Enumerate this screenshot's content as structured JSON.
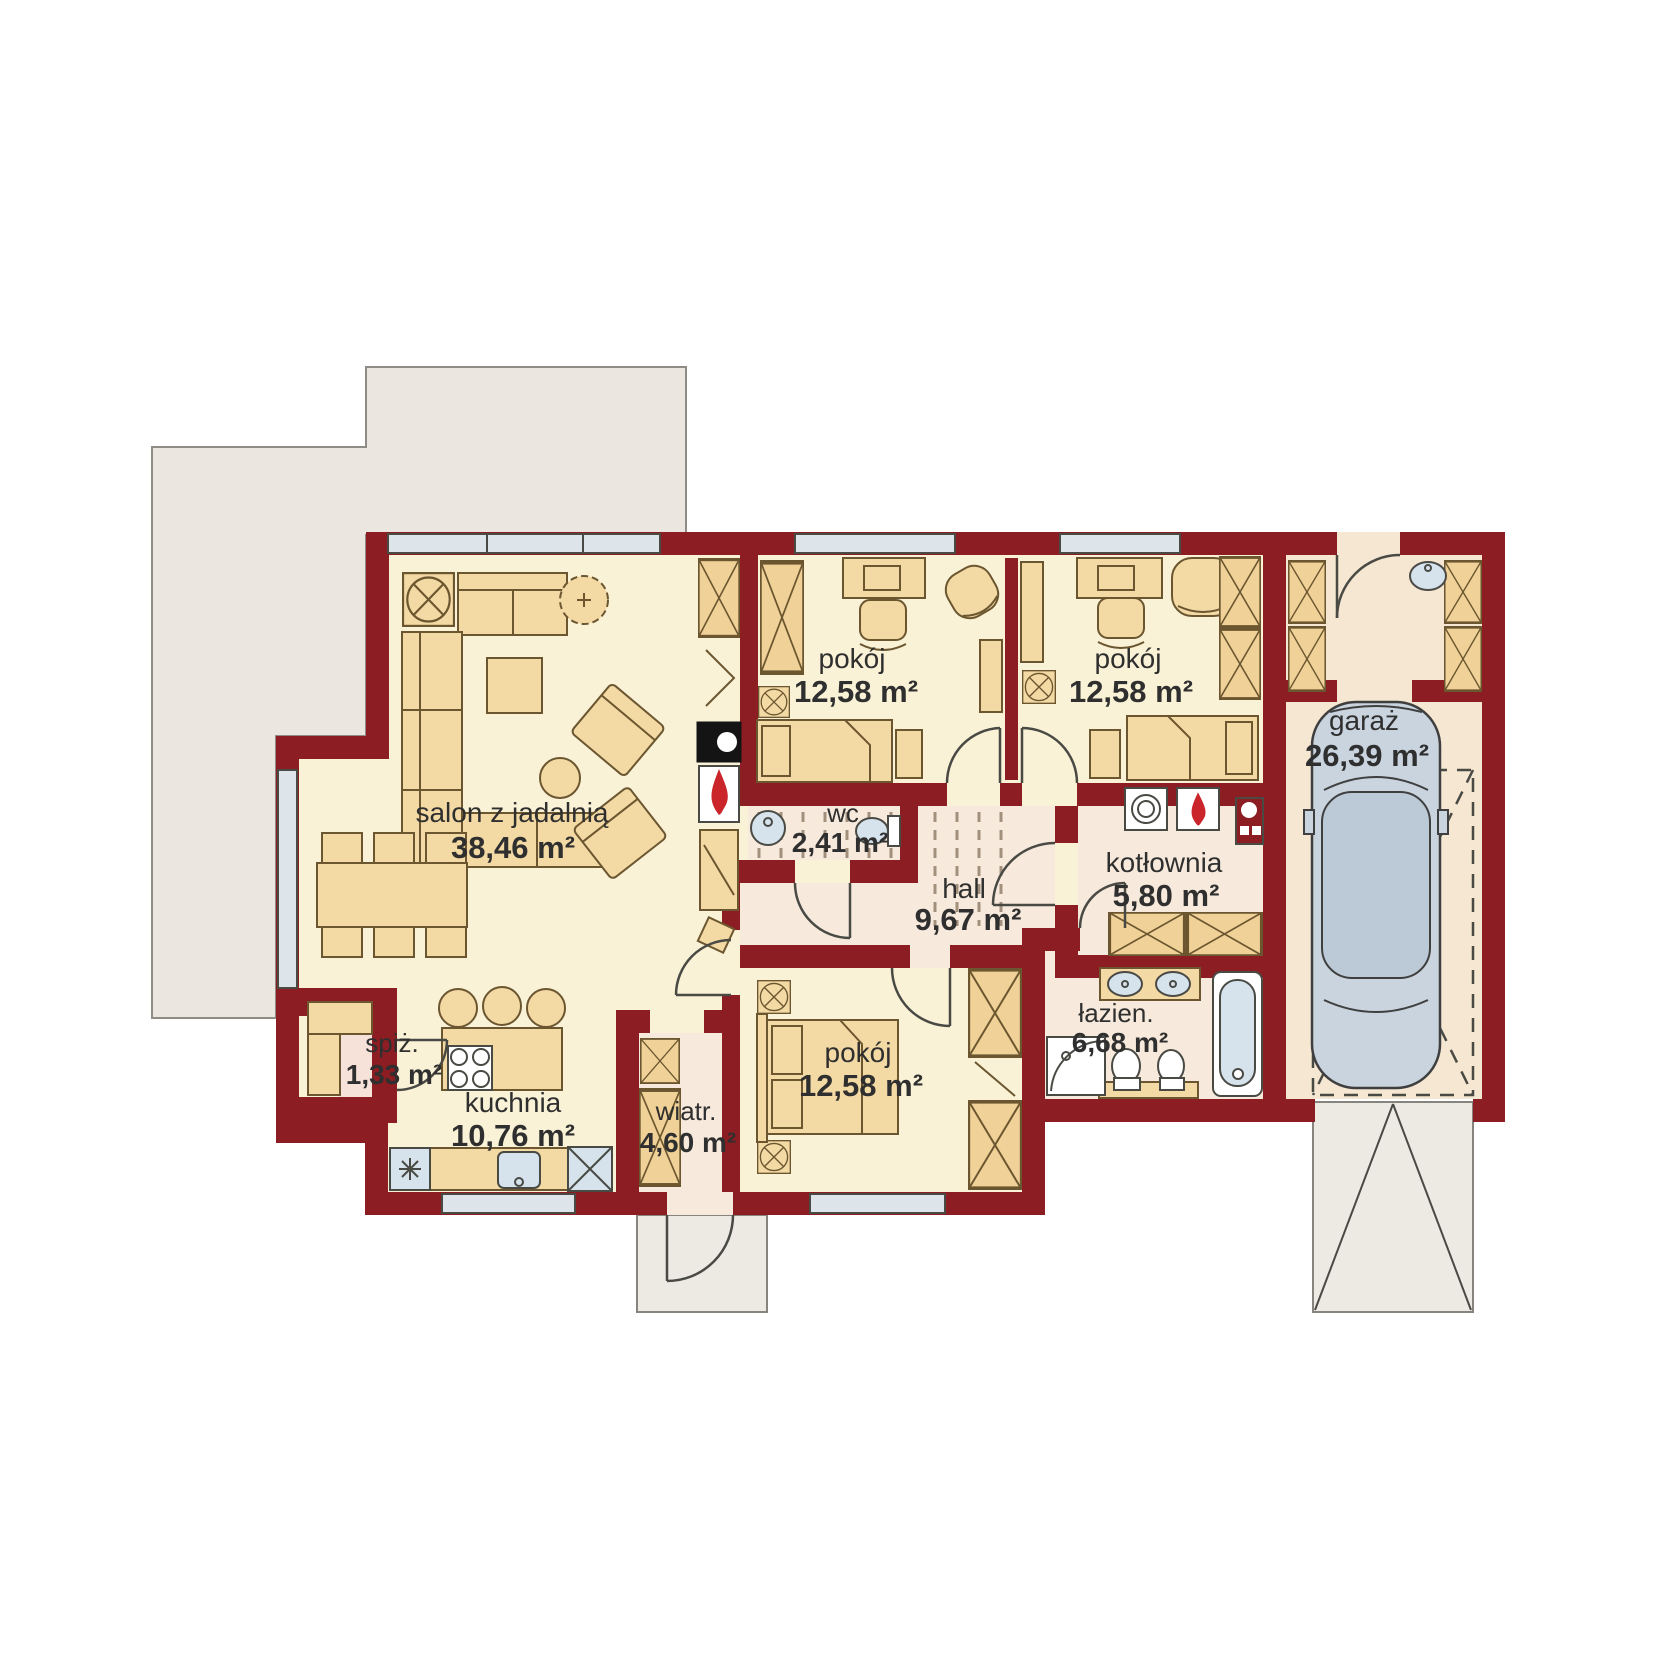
{
  "rooms": [
    {
      "id": "salon",
      "label": "salon z jadalnią",
      "area": "38,46 m²"
    },
    {
      "id": "kuchnia",
      "label": "kuchnia",
      "area": "10,76 m²"
    },
    {
      "id": "spizarnia",
      "label": "spiż.",
      "area": "1,33 m²"
    },
    {
      "id": "wiatrolap",
      "label": "wiatr.",
      "area": "4,60 m²"
    },
    {
      "id": "pokoj-1",
      "label": "pokój",
      "area": "12,58 m²"
    },
    {
      "id": "pokoj-2",
      "label": "pokój",
      "area": "12,58 m²"
    },
    {
      "id": "pokoj-3",
      "label": "pokój",
      "area": "12,58 m²"
    },
    {
      "id": "wc",
      "label": "wc",
      "area": "2,41 m²"
    },
    {
      "id": "hall",
      "label": "hall",
      "area": "9,67 m²"
    },
    {
      "id": "kotlownia",
      "label": "kotłownia",
      "area": "5,80 m²"
    },
    {
      "id": "lazienka",
      "label": "łazien.",
      "area": "6,68 m²"
    },
    {
      "id": "garaz",
      "label": "garaż",
      "area": "26,39 m²"
    }
  ],
  "colors": {
    "wall": "#8C1D22",
    "room_floor": "#FAF2D6",
    "service_floor": "#F7EADC",
    "garage_floor": "#F5E7D2",
    "terrace": "#EBE7E0",
    "furniture": "#F3D9A4",
    "window": "#DDE4EA",
    "fixture_blue": "#D6E3ED",
    "flame": "#C9252B",
    "car": "#C9D4DF",
    "text": "#2F2F2F"
  }
}
